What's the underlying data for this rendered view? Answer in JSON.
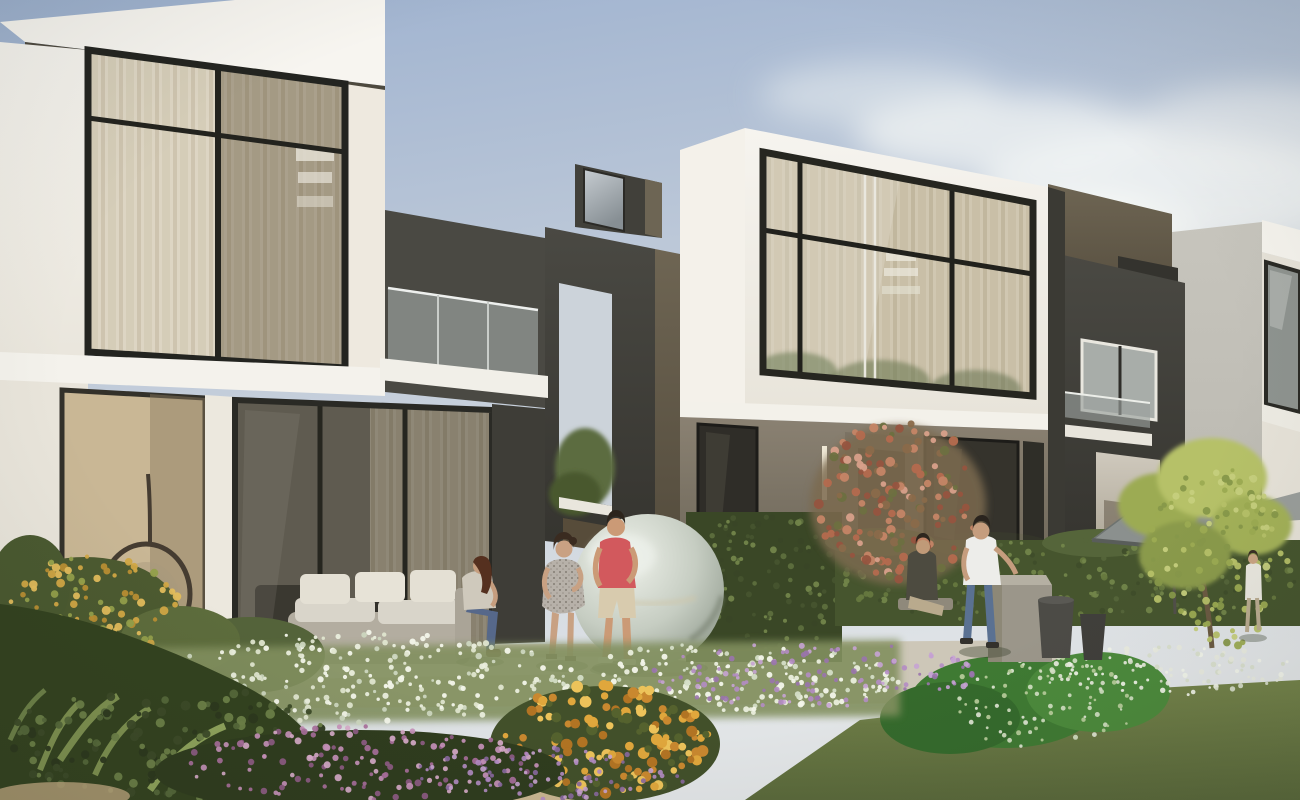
{
  "meta": {
    "title": "Architectural rendering: row of modern two-storey townhouses with dark feature frames, glass facades, landscaped flower garden, mirrored sphere sculpture, patio umbrella and residents outdoors"
  },
  "scene": {
    "description": "Daylight exterior render. Left white villa with large glazed windows and glass balcony, charcoal portal frames between units, middle white villa with full-width upper window, dark right unit with patio umbrella and small tree, lush flower beds (white, purple, yellow, pink, orange marigolds) and lawn in the foreground, six people on the terrace.",
    "palette": {
      "sky_top": "#9db1cf",
      "sky_mid": "#c3cdda",
      "sky_horizon": "#e3e6e8",
      "cloud_white": "#f3f5f4",
      "facade_white": "#f6f4ef",
      "facade_white_shade": "#e8e4da",
      "charcoal_dark": "#35342f",
      "charcoal_mid": "#4a4943",
      "taupe_dark": "#6e6553",
      "taupe_deep": "#544c3d",
      "taupe_wall": "#8a8172",
      "glass_beige": "#c9c2b0",
      "curtain_beige": "#d6cbb2",
      "glass_blue": "#aeb6b5",
      "lit_wall": "#cfc9bd",
      "gray_side_wall": "#bdbbb3",
      "hedge_green": "#46552e",
      "ivy_green": "#3a4726",
      "foliage_dark": "#33421f",
      "lawn_light": "#74834a",
      "lawn_dark": "#5a693b",
      "bright_bush_green": "#3f7a33",
      "tree_yellow_green": "#b6c168",
      "marigold_orange": "#e0a73c",
      "flower_white": "#eaeedd",
      "flower_purple": "#b48cc4",
      "flower_pink": "#c893bb",
      "coral_flower": "#c58566",
      "umbrella_gray": "#8b908e",
      "sphere_light": "#eef1ea",
      "sphere_mid": "#c6cdc2",
      "sphere_dark": "#8f998c",
      "shirt_coral": "#d2595d",
      "shirt_white": "#ededea",
      "dress_gray": "#b7b1a9",
      "denim_blue": "#5a6f8e",
      "skin_tan": "#c9a183",
      "terrace_stone": "#cdc7b8"
    },
    "people": [
      {
        "id": "seated-woman-left",
        "top": "#cfc9bc",
        "bottom": "#56688a",
        "hair": "#55301f"
      },
      {
        "id": "standing-woman",
        "top": "#b7b1a9",
        "hair": "#3a2b20"
      },
      {
        "id": "man-coral-shirt",
        "top": "#d2595d",
        "bottom": "#d8cbae",
        "hair": "#2c241c"
      },
      {
        "id": "seated-person-right",
        "top": "#4d4b40",
        "bottom": "#b9aa8d"
      },
      {
        "id": "man-white-shirt",
        "top": "#ededea",
        "bottom": "#5a7192",
        "hair": "#2a241e"
      },
      {
        "id": "walking-figure-far-right",
        "top": "#e9e7df"
      }
    ],
    "props": [
      "mirrored-sphere-sculpture",
      "outdoor-sofa",
      "hanging-egg-chair",
      "patio-umbrella",
      "storage-box",
      "planter-pots",
      "glass-balcony"
    ],
    "flower_drifts": [
      {
        "name": "yellow-shrub-left",
        "seed": 11,
        "x": 2,
        "y": 556,
        "w": 180,
        "h": 118,
        "count": 150,
        "rmin": 2,
        "rmax": 4.5,
        "colors": [
          "#d2a845",
          "#e3bd5c",
          "#b98f33",
          "#93a04b"
        ],
        "opacity": 0.95
      },
      {
        "name": "white-meadow-left",
        "seed": 21,
        "x": 135,
        "y": 632,
        "w": 440,
        "h": 92,
        "count": 300,
        "rmin": 1.4,
        "rmax": 3.2,
        "colors": [
          "#eaeedd",
          "#f3f6ea",
          "#ccd6bf",
          "#dfe5cf"
        ],
        "opacity": 0.95
      },
      {
        "name": "white-meadow-mid",
        "seed": 31,
        "x": 550,
        "y": 644,
        "w": 350,
        "h": 70,
        "count": 210,
        "rmin": 1.4,
        "rmax": 3.2,
        "colors": [
          "#eaeedd",
          "#f3f6ea",
          "#d4ddc6"
        ],
        "opacity": 0.95
      },
      {
        "name": "purple-drift",
        "seed": 41,
        "x": 650,
        "y": 642,
        "w": 330,
        "h": 66,
        "count": 150,
        "rmin": 1.5,
        "rmax": 3,
        "colors": [
          "#b48cc4",
          "#c7a3d4",
          "#9a74ad"
        ],
        "opacity": 0.9
      },
      {
        "name": "coral-bush",
        "seed": 51,
        "x": 815,
        "y": 420,
        "w": 170,
        "h": 160,
        "count": 210,
        "rmin": 2.5,
        "rmax": 5,
        "colors": [
          "#c58566",
          "#d8a08a",
          "#b46a4e",
          "#8a6a4a",
          "#6d7040",
          "#96543f"
        ],
        "opacity": 0.95
      },
      {
        "name": "marigold",
        "seed": 61,
        "x": 500,
        "y": 684,
        "w": 210,
        "h": 112,
        "count": 190,
        "rmin": 2.8,
        "rmax": 6,
        "colors": [
          "#e0a73c",
          "#c9882f",
          "#edc35a",
          "#b27423",
          "#55622e"
        ],
        "opacity": 1
      },
      {
        "name": "green-speck-mound",
        "seed": 71,
        "x": 945,
        "y": 656,
        "w": 195,
        "h": 92,
        "count": 110,
        "rmin": 1.2,
        "rmax": 2.6,
        "colors": [
          "#e4ead9",
          "#d6e2c6",
          "#bccf9f"
        ],
        "opacity": 0.9
      },
      {
        "name": "lawn-edge-flowers",
        "seed": 81,
        "x": 1050,
        "y": 645,
        "w": 250,
        "h": 50,
        "count": 130,
        "rmin": 1.3,
        "rmax": 2.8,
        "colors": [
          "#e9ecdf",
          "#f2f5ea",
          "#d9e0cc"
        ],
        "opacity": 0.92
      },
      {
        "name": "pink-spikes",
        "seed": 91,
        "x": 180,
        "y": 726,
        "w": 360,
        "h": 74,
        "count": 170,
        "rmin": 1.8,
        "rmax": 3.6,
        "colors": [
          "#c893bb",
          "#d8abca",
          "#a96f9c",
          "#8f5c86"
        ],
        "opacity": 0.92
      },
      {
        "name": "lavender-bottom",
        "seed": 101,
        "x": 410,
        "y": 748,
        "w": 280,
        "h": 52,
        "count": 100,
        "rmin": 1.6,
        "rmax": 3,
        "colors": [
          "#b48cc4",
          "#8a68a0",
          "#c9a3d2"
        ],
        "opacity": 0.9
      },
      {
        "name": "ivy-texture",
        "seed": 111,
        "x": 686,
        "y": 512,
        "w": 156,
        "h": 148,
        "count": 150,
        "rmin": 1.6,
        "rmax": 3.4,
        "colors": [
          "#5d6f3d",
          "#72854a",
          "#46542e",
          "#394626"
        ],
        "opacity": 0.95
      },
      {
        "name": "hedge-texture",
        "seed": 121,
        "x": 835,
        "y": 540,
        "w": 465,
        "h": 84,
        "count": 240,
        "rmin": 1.6,
        "rmax": 3.4,
        "colors": [
          "#55653a",
          "#66783f",
          "#3f4d2a",
          "#72854a"
        ],
        "opacity": 0.95
      },
      {
        "name": "bottomleft-foliage",
        "seed": 131,
        "x": 0,
        "y": 686,
        "w": 340,
        "h": 114,
        "count": 190,
        "rmin": 2.2,
        "rmax": 5,
        "colors": [
          "#3c4a28",
          "#55683a",
          "#6d8148",
          "#2c381d"
        ],
        "opacity": 0.95
      },
      {
        "name": "tree-leaf-speckle",
        "seed": 141,
        "x": 1148,
        "y": 466,
        "w": 140,
        "h": 185,
        "count": 150,
        "rmin": 2,
        "rmax": 4.2,
        "colors": [
          "#b6c168",
          "#9cab52",
          "#c6cf7d",
          "#87984a"
        ],
        "opacity": 0.95
      }
    ]
  }
}
